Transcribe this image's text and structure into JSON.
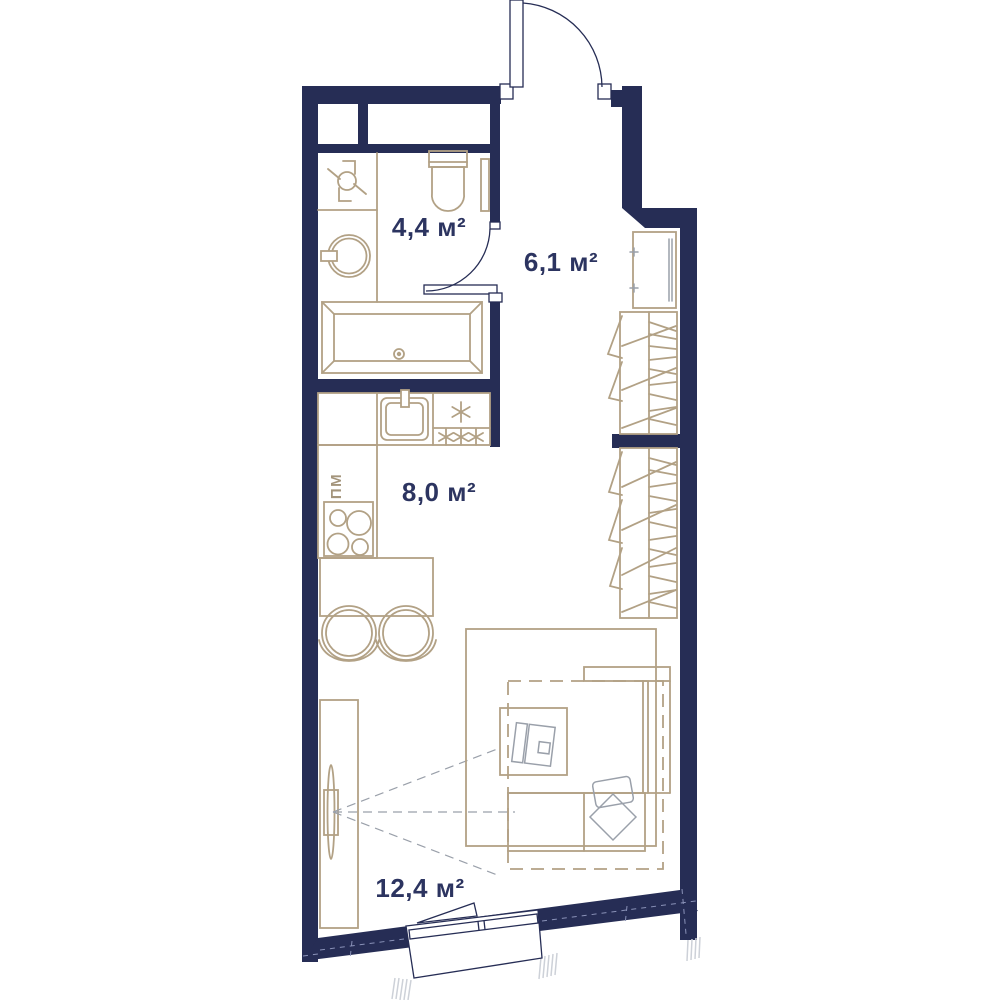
{
  "plan_title": "studio apartment floor plan",
  "colors": {
    "wall": "#262d55",
    "furniture_line": "#b2a185",
    "gray_line": "#9aa0aa",
    "label_text": "#2c3460",
    "dishwasher_label": "#a4957c",
    "background": "#ffffff"
  },
  "rooms": [
    {
      "name": "bathroom",
      "area_label": "4,4 м²"
    },
    {
      "name": "hallway",
      "area_label": "6,1 м²"
    },
    {
      "name": "kitchen",
      "area_label": "8,0 м²"
    },
    {
      "name": "living-room",
      "area_label": "12,4 м²"
    }
  ],
  "annotations": {
    "dishwasher_label": "ПМ",
    "fridge_symbol": "✳",
    "freezer_symbol": "✳✳✳"
  },
  "fixtures": [
    "entrance-door",
    "entrance-door-swing-arc",
    "ventilation-shafts",
    "ventilation-fan-icon",
    "washing-machine-icon",
    "toilet-icon",
    "towel-radiator-icon",
    "bathtub-icon",
    "bathroom-door",
    "kitchen-counter",
    "kitchen-sink-icon",
    "fridge-star-icon",
    "freezer-stars-icon",
    "dishwasher-zone",
    "stove-icon",
    "dining-table",
    "dining-chairs",
    "hallway-cabinet",
    "wardrobe-hall",
    "wardrobe-living",
    "tv-stand",
    "tv-icon",
    "tv-viewing-lines",
    "rug",
    "sofa-bed",
    "bed-fold-out-outline",
    "desk",
    "laptop-icon",
    "desk-chair-icon",
    "window",
    "window-casement"
  ]
}
